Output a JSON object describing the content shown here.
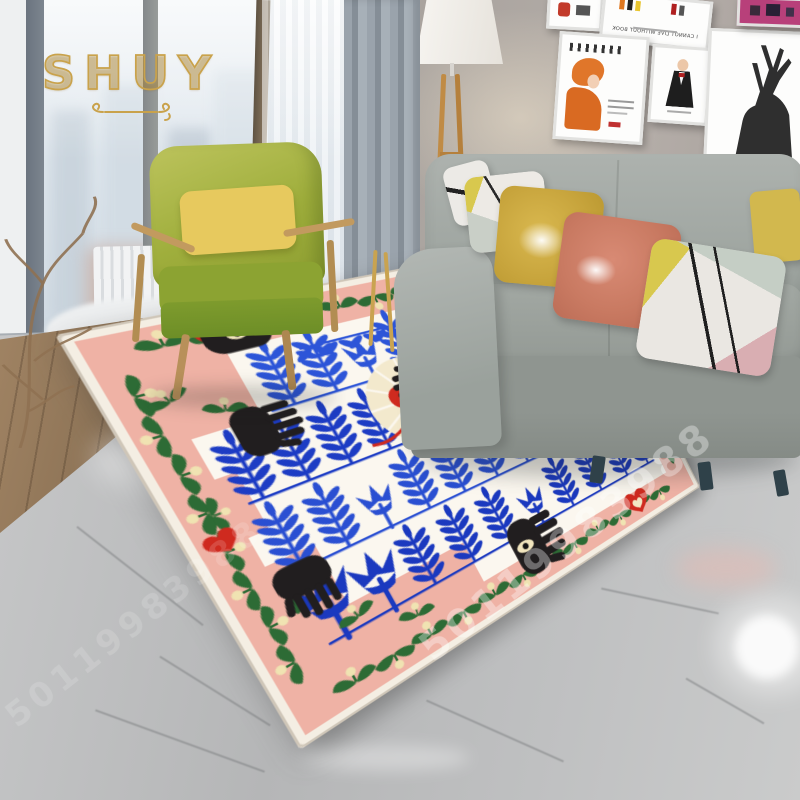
{
  "branding": {
    "logo_text": "SHUY",
    "watermark_id": "50119983988"
  },
  "wall_gallery": {
    "poster_text": "I CANNOT LIVE WITHOUT BOOK",
    "posters": [
      "typography-poster",
      "orange-figure-poster",
      "suit-figure-poster",
      "deer-silhouette-poster",
      "magenta-art-poster"
    ]
  },
  "rug": {
    "style": "bohemian botanical area rug",
    "motifs": [
      "blue fern branches",
      "blue tulips",
      "hamsa hands with eye",
      "red hearts",
      "cream sunburst",
      "green tulip vine border"
    ]
  },
  "colors": {
    "gold": "#c9a24b",
    "rug-pink": "#efb2a5",
    "rug-field": "#fbf7ef",
    "branch-blue": "#2247cd",
    "vine-green": "#2d6b35",
    "heart-red": "#cf2a1f",
    "hand-black": "#211e1f",
    "sun-cream": "#f3e9cd",
    "sofa-gray": "#9ba19c",
    "chair-green": "#9aa93a",
    "pillow-mustard": "#c7a43c",
    "pillow-coral": "#c97a62",
    "lamp-wood": "#c08b45",
    "watermark-white": "#ffffff"
  }
}
